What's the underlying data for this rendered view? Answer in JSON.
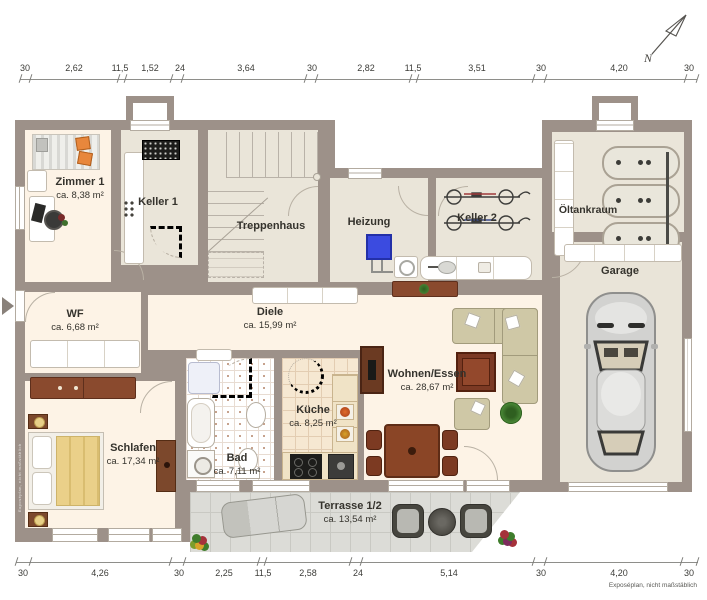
{
  "meta": {
    "footer": "Exposéplan, nicht maßstäblich",
    "north_label": "N",
    "plan_type": "basement floor plan"
  },
  "colors": {
    "wall": "#9d9189",
    "room_floor": "#fdf3e6",
    "cellar_floor": "#eae5d9",
    "boiler_accent": "#3b4be0",
    "wood_furniture": "#8a4a2e",
    "sofa": "#cfc8a6",
    "terrace_tile": "#dcdcd7"
  },
  "rooms": {
    "zimmer1": {
      "name": "Zimmer 1",
      "area": "ca. 8,38 m²"
    },
    "keller1": {
      "name": "Keller 1",
      "area": ""
    },
    "treppenhaus": {
      "name": "Treppenhaus",
      "area": ""
    },
    "heizung": {
      "name": "Heizung",
      "area": ""
    },
    "keller2": {
      "name": "Keller 2",
      "area": ""
    },
    "oeltankraum": {
      "name": "Öltankraum",
      "area": ""
    },
    "garage": {
      "name": "Garage",
      "area": ""
    },
    "wf": {
      "name": "WF",
      "area": "ca. 6,68 m²"
    },
    "diele": {
      "name": "Diele",
      "area": "ca. 15,99 m²"
    },
    "wohnen": {
      "name": "Wohnen/Essen",
      "area": "ca. 28,67 m²"
    },
    "schlafen": {
      "name": "Schlafen",
      "area": "ca. 17,34 m²"
    },
    "bad": {
      "name": "Bad",
      "area": "ca. 7,11 m²"
    },
    "kueche": {
      "name": "Küche",
      "area": "ca. 8,25 m²"
    },
    "terrasse": {
      "name": "Terrasse 1/2",
      "area": "ca. 13,54 m²"
    }
  },
  "dimensions": {
    "top": [
      "30",
      "2,62",
      "11,5",
      "1,52",
      "24",
      "3,64",
      "30",
      "2,82",
      "11,5",
      "3,51",
      "30",
      "4,20",
      "30"
    ],
    "bottom": [
      "30",
      "4,26",
      "30",
      "2,25",
      "11,5",
      "2,58",
      "24",
      "5,14",
      "30",
      "4,20",
      "30"
    ]
  }
}
